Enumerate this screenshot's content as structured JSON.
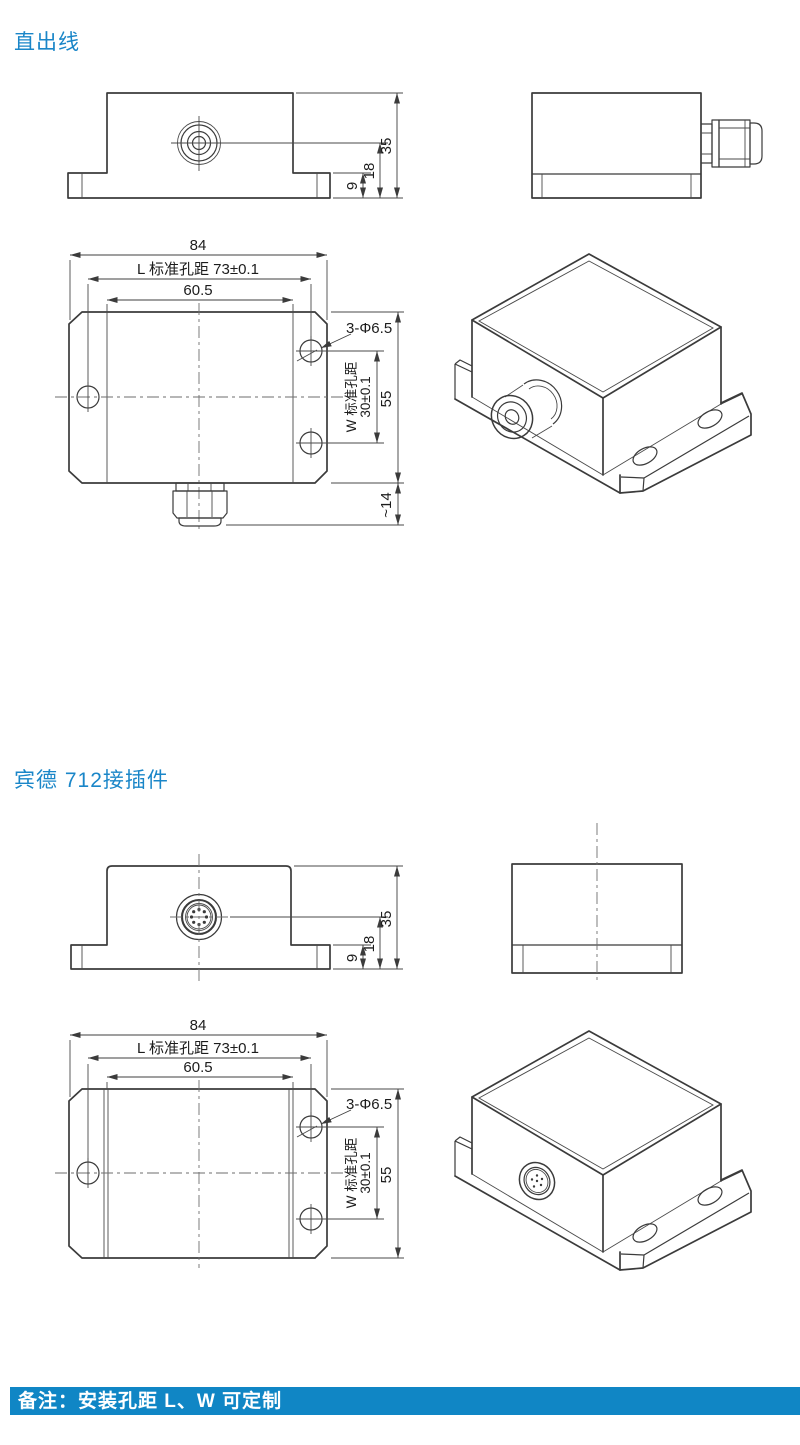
{
  "colors": {
    "accent_blue": "#1a86c8",
    "banner_background": "#1086c5",
    "banner_text": "#ffffff",
    "drawing_line": "#3b3b3b"
  },
  "sections": [
    {
      "title": "直出线",
      "front": {
        "h_total": "35",
        "h_mid": "18",
        "h_base": "9"
      },
      "top": {
        "w_total": "84",
        "pitch_l": "L 标准孔距 73±0.1",
        "w_body": "60.5",
        "holes": "3-Φ6.5",
        "pitch_w_label": "W 标准孔距",
        "pitch_w_value": "30±0.1",
        "d_total": "55",
        "gland_depth": "~14"
      }
    },
    {
      "title": "宾德 712接插件",
      "front": {
        "h_total": "35",
        "h_mid": "18",
        "h_base": "9"
      },
      "top": {
        "w_total": "84",
        "pitch_l": "L 标准孔距 73±0.1",
        "w_body": "60.5",
        "holes": "3-Φ6.5",
        "pitch_w_label": "W 标准孔距",
        "pitch_w_value": "30±0.1",
        "d_total": "55"
      }
    }
  ],
  "footer": {
    "note": "备注：安装孔距 L、W 可定制"
  }
}
